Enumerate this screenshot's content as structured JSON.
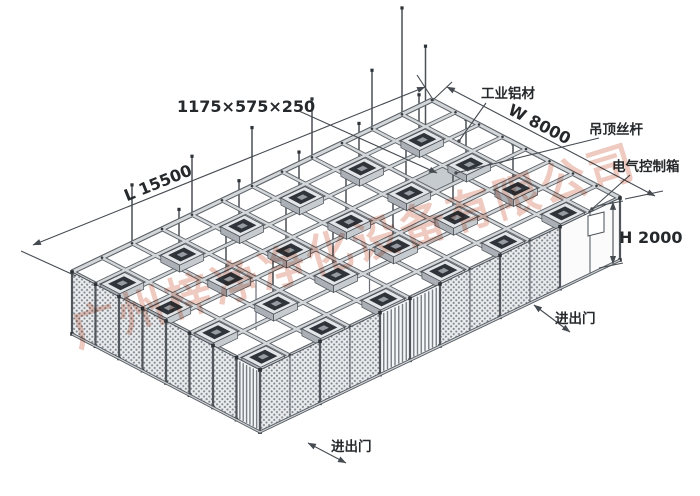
{
  "drawing": {
    "dimension_labels": {
      "ffu_size": "1175×575×250",
      "length": "L 15500",
      "width": "W 8000",
      "height": "H 2000"
    },
    "part_labels": {
      "aluminum_frame": "工业铝材",
      "ceiling_rod": "吊顶丝杆",
      "electrical_box": "电气控制箱",
      "door_right": "进出门",
      "door_bottom": "进出门"
    },
    "structure": {
      "grid_cells_long": 12,
      "grid_cells_wide": 8,
      "ffu_cols": 6,
      "ffu_rows": 4,
      "ffu_count": 24,
      "wall_height_px": 62
    },
    "watermark": {
      "text": "广州梓净净化设备有限公司",
      "color": "#de9681"
    },
    "colors": {
      "line": "#454b51",
      "beam_light": "#d3d7da",
      "beam_dark": "#5c6268",
      "mesh_bg": "#e9ebed",
      "mesh_dot": "#80868d",
      "ffu_top": "#2f343a",
      "shaded_cell": "#c6cbd0",
      "panel": "#fbfbfc"
    }
  }
}
